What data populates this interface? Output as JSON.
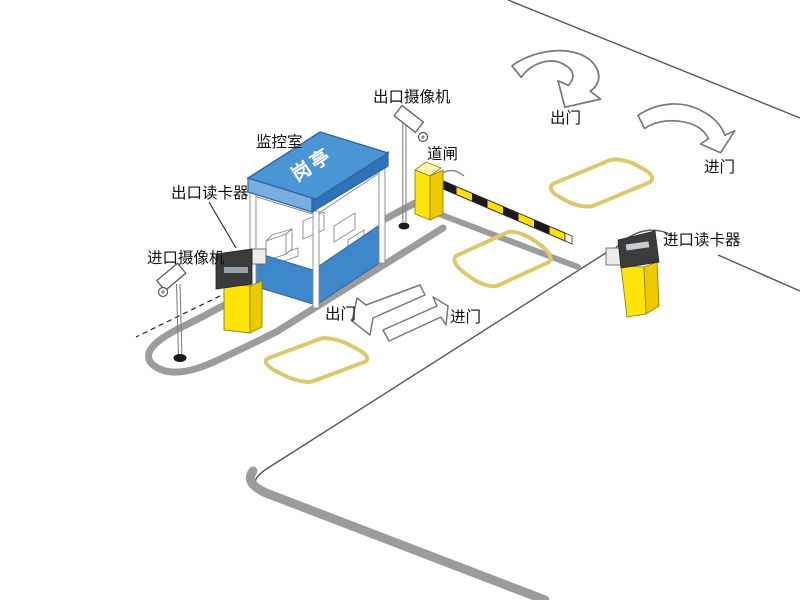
{
  "colors": {
    "booth_blue": "#4C95D5",
    "booth_blue_dark": "#2F72B7",
    "booth_blue_light": "#79AEE0",
    "panel_blue": "#3E87CB",
    "device_yellow": "#FFE40A",
    "device_yellow_side": "#EFC900",
    "device_yellow_top": "#FFF5B0",
    "loop_gold": "#DCC86E",
    "curb_gray": "#9C9C9C",
    "line_dark": "#555555",
    "reader_dark": "#3B3B3B",
    "text_black": "#111111",
    "roof_text_white": "#FFFFFF"
  },
  "labels": {
    "exit_camera": "出口摄像机",
    "monitor_room": "监控室",
    "barrier_gate": "道闸",
    "exit_reader": "出口读卡器",
    "entrance_camera": "进口摄像机",
    "entrance_reader": "进口读卡器",
    "exit_top": "出门",
    "enter_top": "进门",
    "exit_mid": "出门",
    "enter_mid": "进门",
    "booth_roof": "岗亭"
  }
}
